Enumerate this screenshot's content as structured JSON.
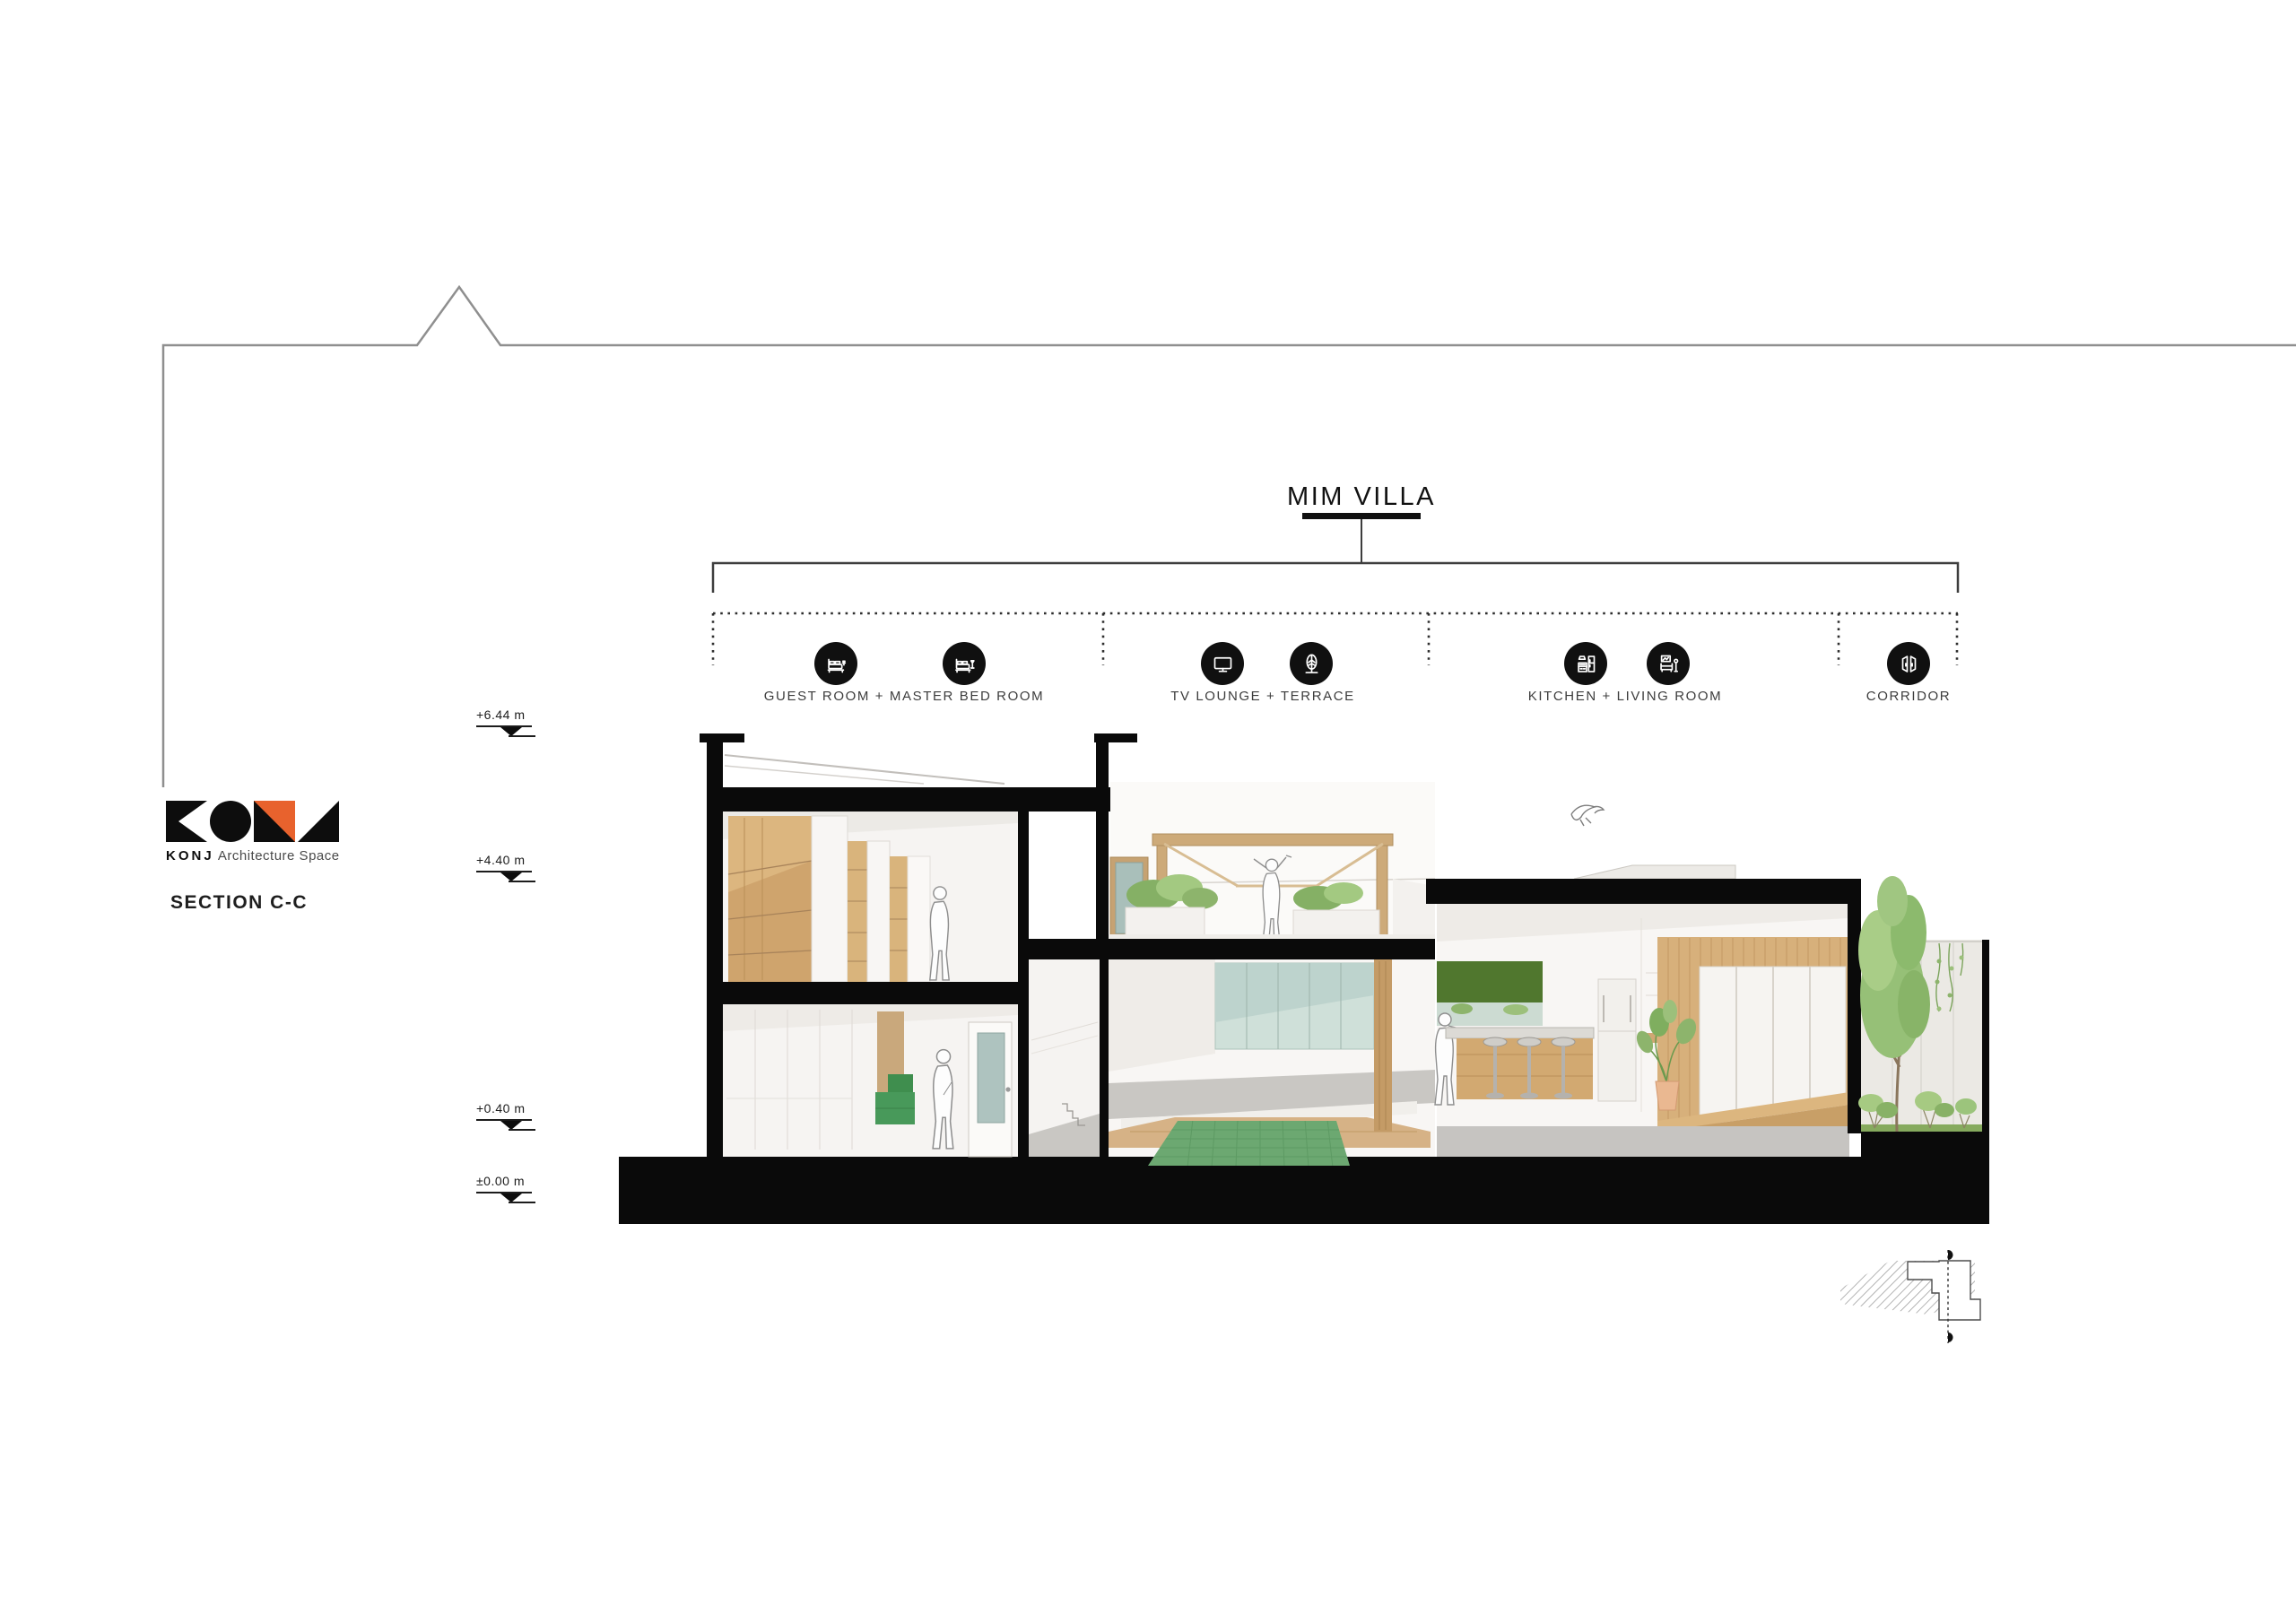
{
  "branding": {
    "logo_text": "KONJ",
    "logo_tagline": "Architecture Space",
    "accent_color": "#E8622D"
  },
  "drawing": {
    "project_title": "MIM VILLA",
    "section_label": "SECTION C-C"
  },
  "zones": [
    {
      "label": "GUEST ROOM + MASTER BED ROOM",
      "icons": [
        "double-bed-icon",
        "bed-with-lamp-icon"
      ]
    },
    {
      "label": "TV LOUNGE + TERRACE",
      "icons": [
        "tv-icon",
        "tree-leaf-icon"
      ]
    },
    {
      "label": "KITCHEN + LIVING ROOM",
      "icons": [
        "kitchen-units-icon",
        "sofa-lamp-icon"
      ]
    },
    {
      "label": "CORRIDOR",
      "icons": [
        "open-doors-icon"
      ]
    }
  ],
  "levels": [
    {
      "label": "+6.44 m"
    },
    {
      "label": "+4.40 m"
    },
    {
      "label": "+0.40 m"
    },
    {
      "label": "±0.00 m"
    }
  ],
  "palette": {
    "ink_black": "#0a0a0a",
    "line_gray": "#8f8f8f",
    "interior_white": "#f7f5f3",
    "wood": "#d2a96e",
    "deck_wood": "#d6b286",
    "pool_green": "#6ca871",
    "bed_green": "#3f8e4e",
    "backsplash_green": "#50772e",
    "glass_teal": "#cfe0d9",
    "foliage_green": "#96c077",
    "floor_gray": "#c6c4c1",
    "logo_orange": "#E8622D"
  }
}
